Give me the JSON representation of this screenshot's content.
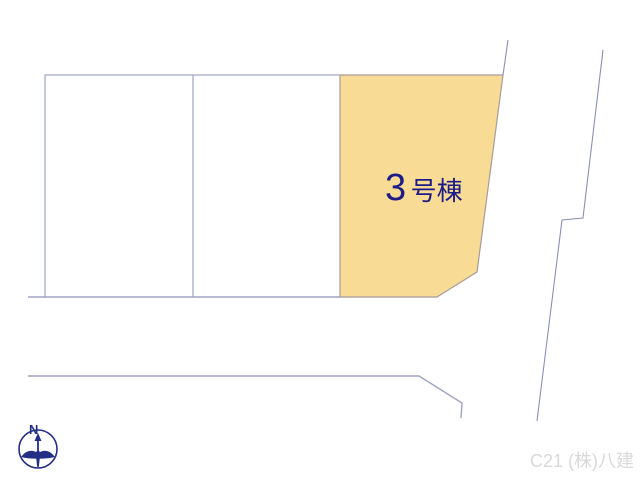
{
  "map": {
    "lots": {
      "vacant_count": 2,
      "highlighted": {
        "label": "3号棟",
        "number": "3",
        "suffix": "号棟",
        "fill": "#f8db94",
        "label_color": "#1c1c86"
      }
    },
    "compass": {
      "label": "N",
      "color": "#232f86"
    },
    "watermark": {
      "text": "C21 (株)八建",
      "color": "#d9d9d9"
    },
    "colors": {
      "boundary_line": "#8c90b8",
      "road_line": "#9fa3c3",
      "highlighted_lot_border": "#a89b9b"
    }
  }
}
